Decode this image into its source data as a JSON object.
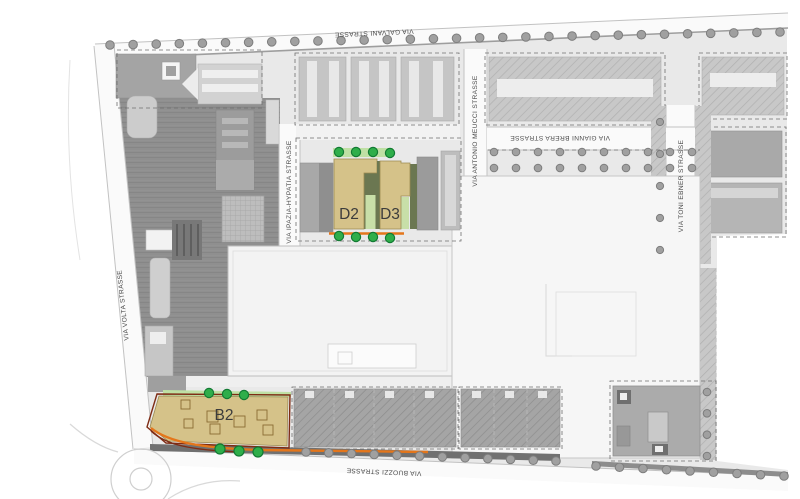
{
  "streets": {
    "galvani": "VIA GALVANI STRASSE",
    "volta": "VIA VOLTA STRASSE",
    "buozzi": "VIA BUOZZI STRASSE",
    "ipazia": "VIA IPAZIA-HYPATIA STRASSE",
    "meucci": "VIA ANTONIO MEUCCI STRASSE",
    "brera": "VIA GIANNI BRERA STRASSE",
    "ebner": "VIA TONI EBNER STRASSE"
  },
  "buildings": {
    "d2": {
      "label": "D2"
    },
    "d3": {
      "label": "D3"
    },
    "b2": {
      "label": "B2"
    }
  },
  "colors": {
    "highlight_fill": "#d5c289",
    "highlight_shadow": "#6b7751",
    "highlight_green": "#c8dfa8",
    "green_strip": "#bfe0a4",
    "tree_green": "#2fae4a",
    "accent_orange": "#e4761b",
    "parcel_red": "#7e2c15"
  },
  "tree_rows": [
    {
      "group": "trees-galvani",
      "cls": "tree-gray",
      "x1": 110,
      "y1": 45,
      "x2": 780,
      "y2": 32,
      "count": 30,
      "r": 4.3
    },
    {
      "group": "trees-buozzi-west",
      "cls": "tree-gray",
      "x1": 306,
      "y1": 452,
      "x2": 556,
      "y2": 461,
      "count": 12,
      "r": 4.3
    },
    {
      "group": "trees-buozzi-east",
      "cls": "tree-gray",
      "x1": 596,
      "y1": 466,
      "x2": 784,
      "y2": 476,
      "count": 9,
      "r": 4.3
    },
    {
      "group": "trees-brera-north",
      "cls": "tree-gray",
      "x1": 494,
      "y1": 152,
      "x2": 692,
      "y2": 152,
      "count": 10,
      "r": 3.8
    },
    {
      "group": "trees-brera-south",
      "cls": "tree-gray",
      "x1": 494,
      "y1": 168,
      "x2": 692,
      "y2": 168,
      "count": 10,
      "r": 3.8
    },
    {
      "group": "trees-ebner",
      "cls": "tree-gray",
      "x1": 660,
      "y1": 122,
      "x2": 660,
      "y2": 250,
      "count": 5,
      "r": 3.6
    },
    {
      "group": "trees-east-edge",
      "cls": "tree-gray",
      "x1": 707,
      "y1": 392,
      "x2": 707,
      "y2": 456,
      "count": 4,
      "r": 3.8
    },
    {
      "group": "trees-d-top",
      "cls": "tree-green",
      "points": [
        [
          339,
          152
        ],
        [
          356,
          152
        ],
        [
          373,
          152
        ],
        [
          390,
          153
        ]
      ],
      "r": 4.6
    },
    {
      "group": "trees-d-bottom",
      "cls": "tree-green",
      "points": [
        [
          339,
          236
        ],
        [
          356,
          237
        ],
        [
          373,
          237
        ],
        [
          390,
          238
        ]
      ],
      "r": 4.6
    },
    {
      "group": "trees-b2-top",
      "cls": "tree-green",
      "points": [
        [
          209,
          393
        ],
        [
          227,
          394
        ],
        [
          244,
          395
        ]
      ],
      "r": 4.6
    },
    {
      "group": "trees-b2-bottom",
      "cls": "tree-green",
      "points": [
        [
          220,
          449
        ],
        [
          239,
          451
        ],
        [
          258,
          452
        ]
      ],
      "r": 5
    }
  ]
}
